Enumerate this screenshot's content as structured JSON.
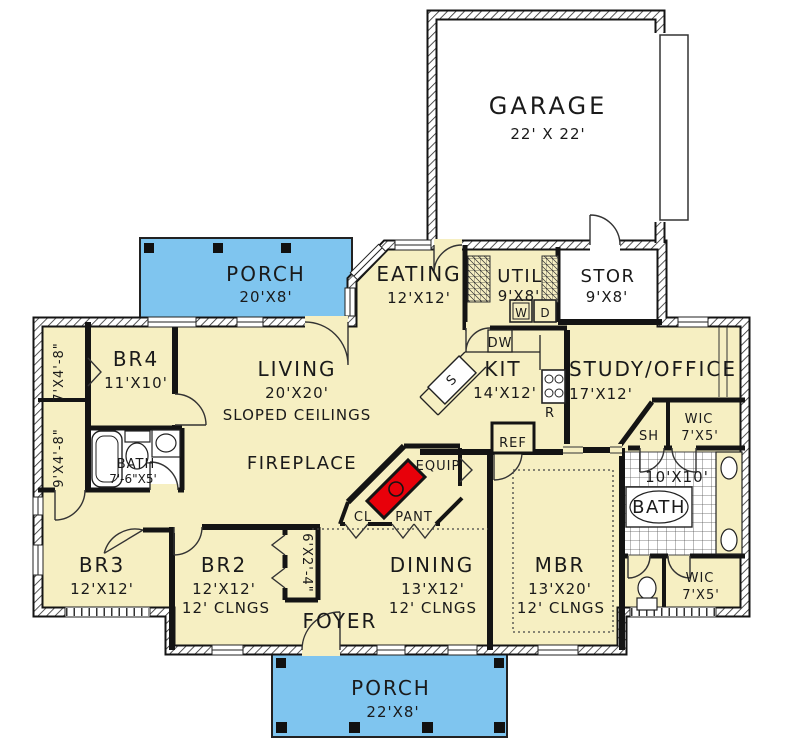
{
  "plan": {
    "rooms": {
      "garage": {
        "name": "GARAGE",
        "dims": "22' X 22'"
      },
      "porch_top": {
        "name": "PORCH",
        "dims": "20'X8'"
      },
      "porch_bottom": {
        "name": "PORCH",
        "dims": "22'X8'"
      },
      "eating": {
        "name": "EATING",
        "dims": "12'X12'"
      },
      "util": {
        "name": "UTIL",
        "dims": "9'X8'"
      },
      "stor": {
        "name": "STOR",
        "dims": "9'X8'"
      },
      "br4": {
        "name": "BR4",
        "dims": "11'X10'"
      },
      "living": {
        "name": "LIVING",
        "dims": "20'X20'",
        "note": "SLOPED CEILINGS"
      },
      "kit": {
        "name": "KIT",
        "dims": "14'X12'"
      },
      "study": {
        "name": "STUDY/OFFICE",
        "dims": "17'X12'"
      },
      "wic_upper": {
        "name": "WIC",
        "dims": "7'X5'"
      },
      "master_bath": {
        "name": "BATH",
        "dims": "10'X10'"
      },
      "hall_bath": {
        "name": "BATH",
        "dims": "7'-6\"X5'"
      },
      "shower": {
        "name": "SH"
      },
      "br3": {
        "name": "BR3",
        "dims": "12'X12'"
      },
      "br2": {
        "name": "BR2",
        "dims": "12'X12'",
        "note": "12' CLNGS"
      },
      "dining": {
        "name": "DINING",
        "dims": "13'X12'",
        "note": "12' CLNGS"
      },
      "mbr": {
        "name": "MBR",
        "dims": "13'X20'",
        "note": "12' CLNGS"
      },
      "foyer": {
        "name": "FOYER"
      },
      "wic_lower": {
        "name": "WIC",
        "dims": "7'X5'"
      },
      "closet_hall_upper": {
        "dims": "7'X4'-8\""
      },
      "closet_hall_lower": {
        "dims": "9'X4'-8\""
      },
      "closet_br2": {
        "dims": "6'X2'-4\""
      },
      "closet": {
        "name": "CL"
      },
      "pantry": {
        "name": "PANT"
      },
      "equip": {
        "name": "EQUIP"
      },
      "fireplace": {
        "name": "FIREPLACE"
      }
    },
    "appliances": {
      "washer": "W",
      "dryer": "D",
      "dishwasher": "DW",
      "range": "R",
      "refrigerator": "REF",
      "sink": "S"
    },
    "colors": {
      "floor_cream": "#F6EFC2",
      "porch_blue": "#7FC5EF",
      "wall_black": "#141414",
      "fireplace_red": "#E8000A",
      "floor_white": "#FFFFFF",
      "tile_line": "#555555"
    }
  }
}
